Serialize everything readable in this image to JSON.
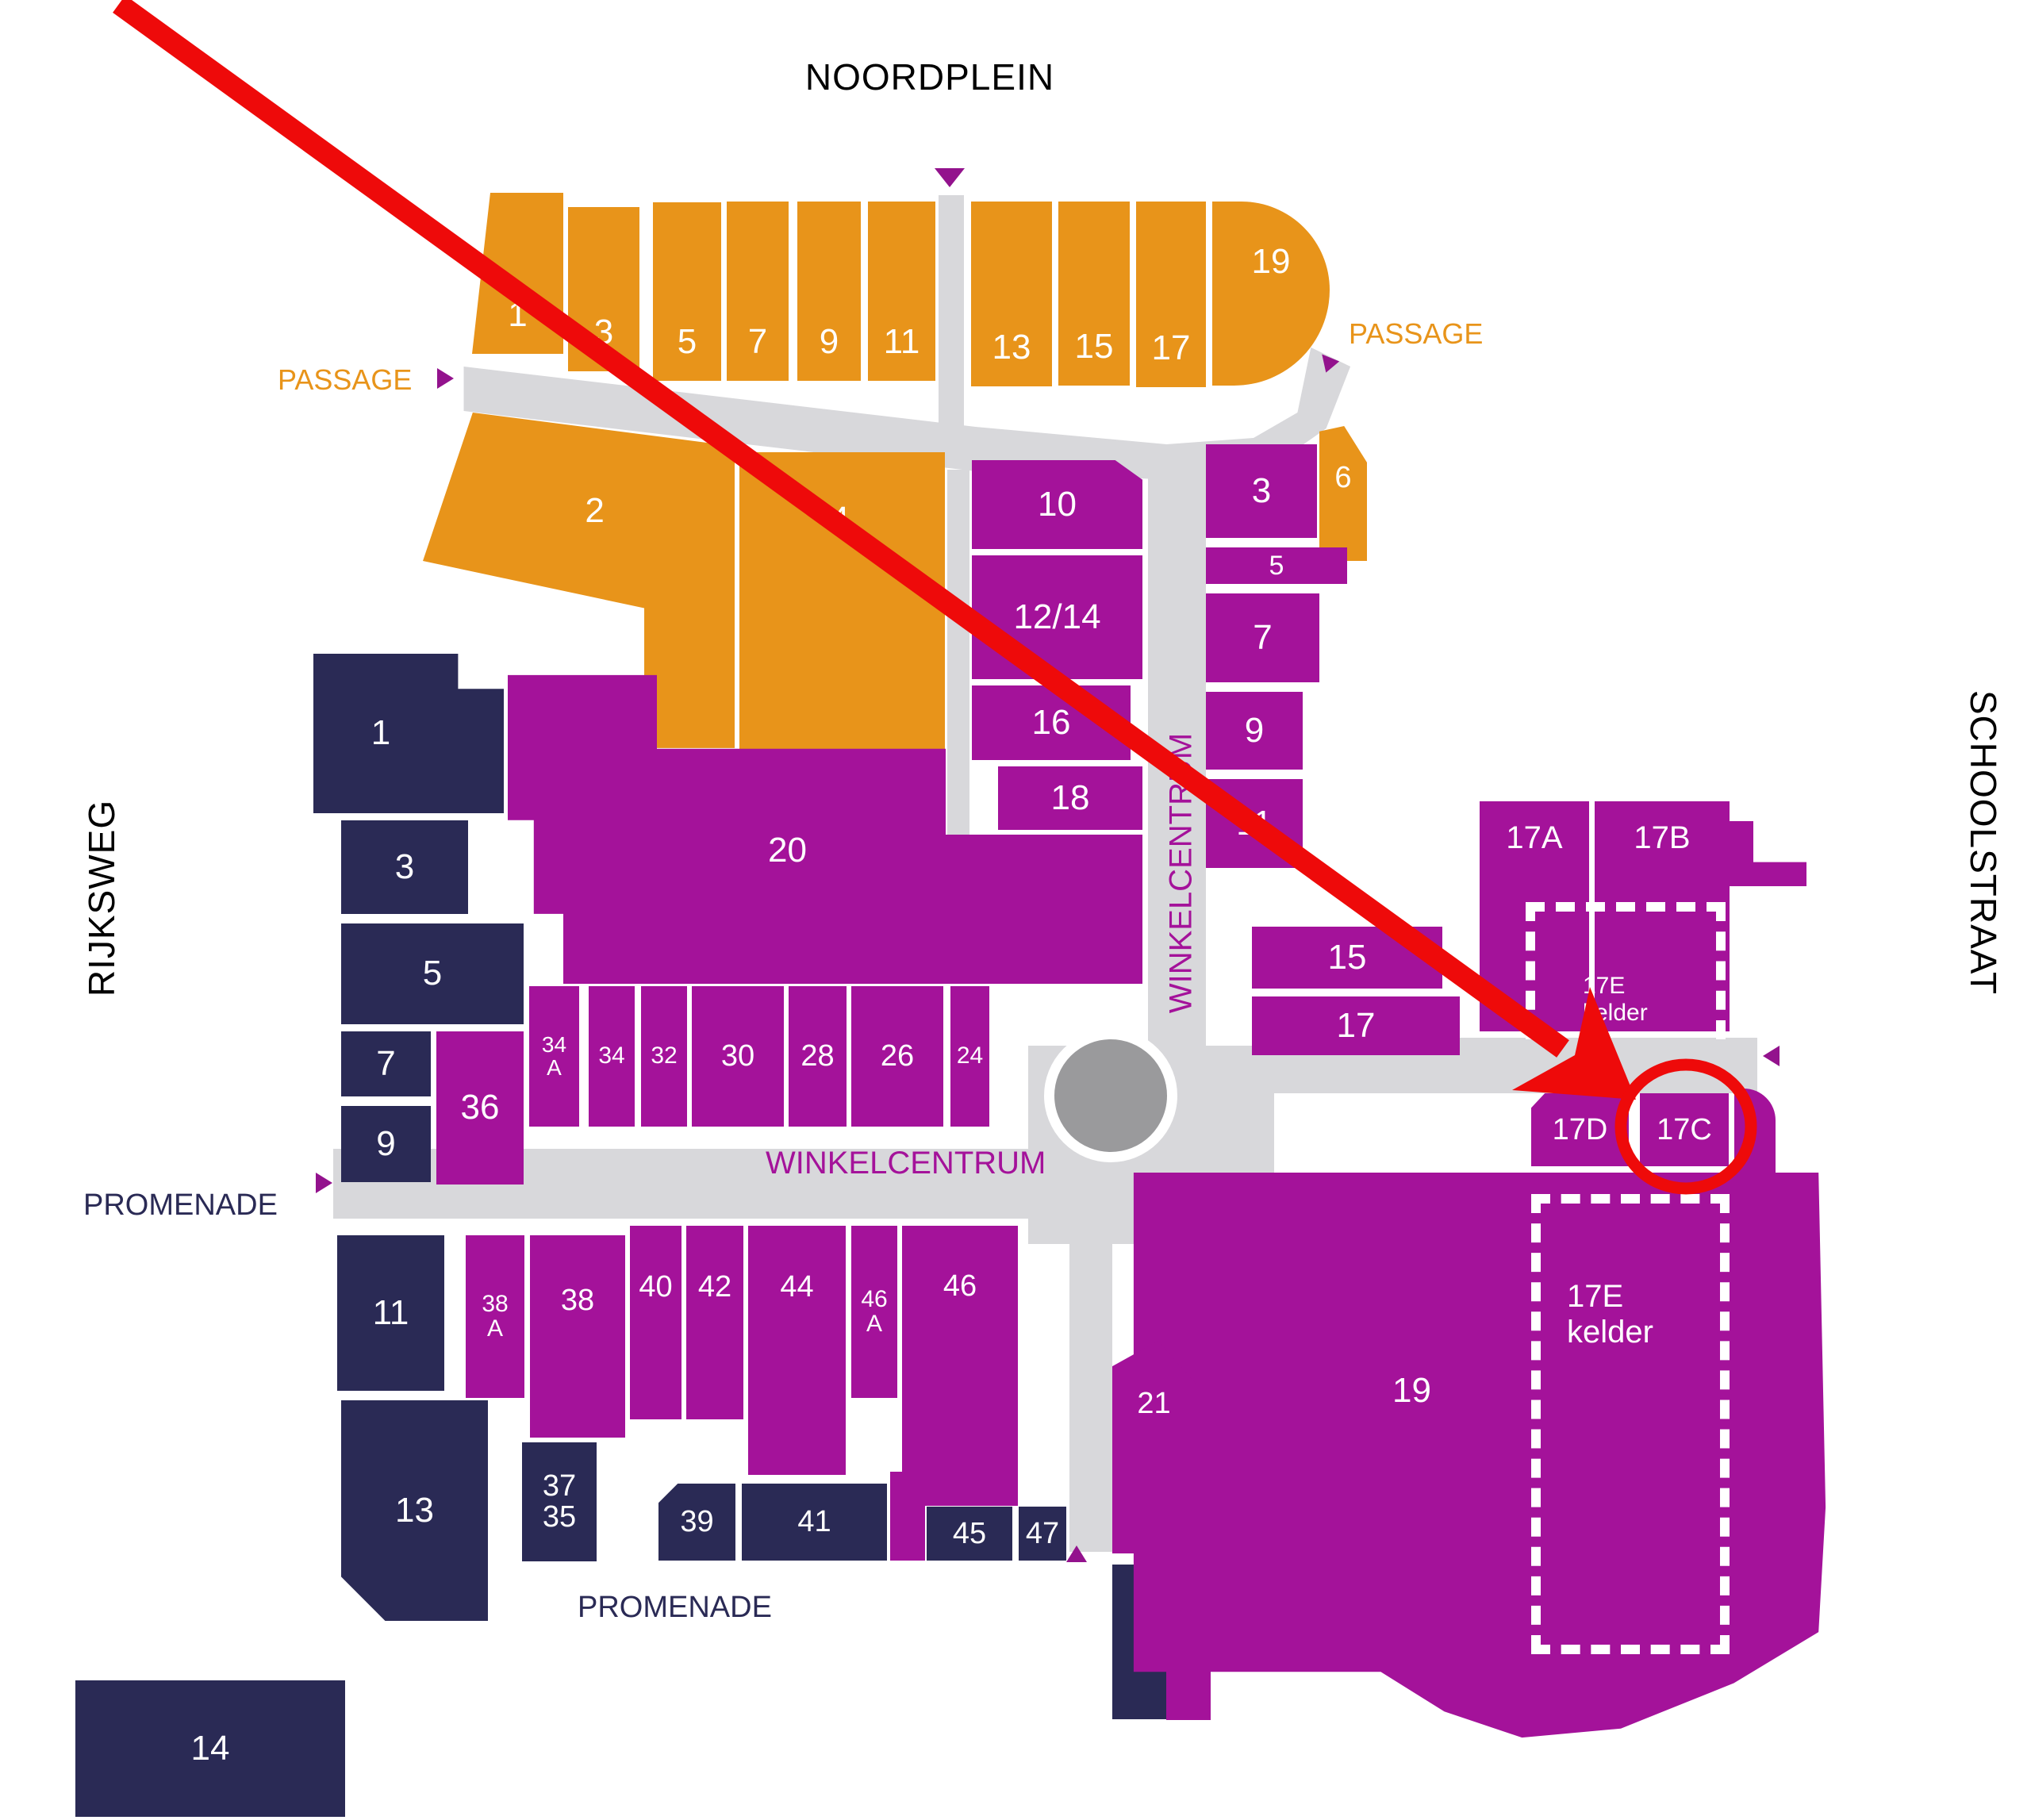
{
  "streets": {
    "north": "NOORDPLEIN",
    "west": "RIJKSWEG",
    "east": "SCHOOLSTRAAT"
  },
  "walkway_labels": {
    "passage_left": "PASSAGE",
    "passage_right": "PASSAGE",
    "promenade_west": "PROMENADE",
    "promenade_south": "PROMENADE",
    "winkelcentrum_horizontal": "WINKELCENTRUM",
    "winkelcentrum_vertical": "WINKELCENTRUM"
  },
  "colors": {
    "orange_units": "#E8941A",
    "purple_units": "#A4129A",
    "navy_units": "#2A2A55",
    "walkway": "#D8D8DB",
    "roundabout": "#9A9A9C",
    "highlight": "#EE0A0A"
  },
  "highlight": {
    "circled_unit": "17C"
  },
  "units": {
    "no1": "1",
    "no3": "3",
    "no5": "5",
    "no7": "7",
    "no9": "9",
    "no11": "11",
    "no13": "13",
    "no15": "15",
    "no17": "17",
    "no19": "19",
    "pa2": "2",
    "pa4": "4",
    "pa6": "6",
    "c10": "10",
    "c12_14": "12/14",
    "c16": "16",
    "c18": "18",
    "e3": "3",
    "e5": "5",
    "e7": "7",
    "e9": "9",
    "e11": "11",
    "e15": "15",
    "e17": "17",
    "e17a": "17A",
    "e17b": "17B",
    "e17d": "17D",
    "e17c": "17C",
    "ke1": "17E",
    "ke2": "kelder",
    "w1": "1",
    "w3": "3",
    "w5": "5",
    "w7": "7",
    "w9": "9",
    "w11": "11",
    "w13": "13",
    "w14": "14",
    "p20": "20",
    "p36": "36",
    "p34a1": "34",
    "p34a2": "A",
    "p34": "34",
    "p32": "32",
    "p30": "30",
    "p28": "28",
    "p26": "26",
    "p24": "24",
    "p38a1": "38",
    "p38a2": "A",
    "p38": "38",
    "p40": "40",
    "p42": "42",
    "p44": "44",
    "p46a1": "46",
    "p46a2": "A",
    "p46": "46",
    "p21": "21",
    "p19": "19",
    "s37": "37",
    "s35": "35",
    "s39": "39",
    "s41": "41",
    "s45": "45",
    "s47": "47",
    "s49": "49"
  }
}
